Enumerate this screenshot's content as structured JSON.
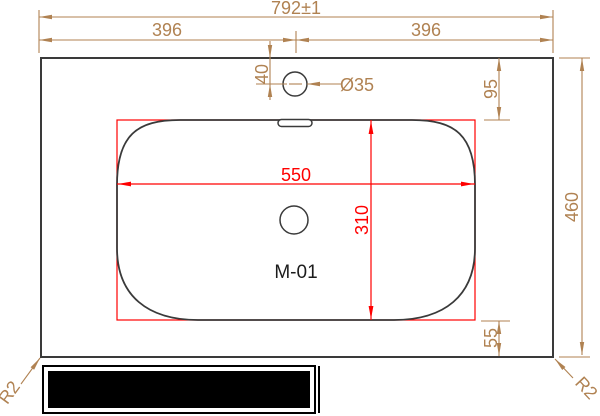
{
  "drawing": {
    "model_label": "M-01",
    "dims": {
      "total_width": "792±1",
      "left_half": "396",
      "right_half": "396",
      "faucet_setback": "40",
      "faucet_hole": "Ø35",
      "top_to_basin": "95",
      "total_depth": "460",
      "basin_width": "550",
      "basin_depth": "310",
      "basin_to_front": "55",
      "corner_radius_left": "R2",
      "corner_radius_right": "R2"
    },
    "colors": {
      "dimension_color": "#b08252",
      "basin_dimension_color": "#ff0000",
      "line_color": "#3a3a3a"
    }
  }
}
